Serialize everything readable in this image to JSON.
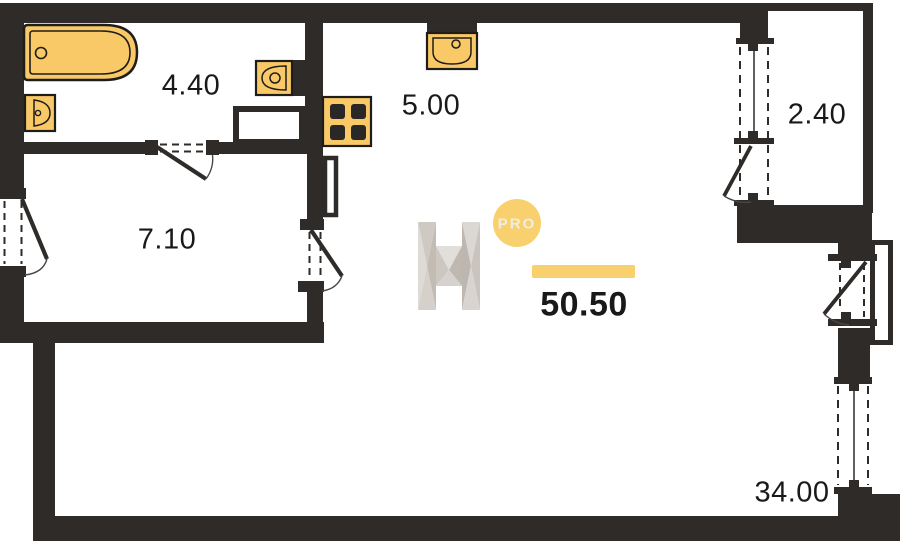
{
  "plan": {
    "title": "apartment floor plan",
    "total_area_label": "50.50",
    "watermark": {
      "logo_letter": "H",
      "badge_label": "PRO"
    },
    "rooms": [
      {
        "name": "bathroom",
        "area_label": "4.40"
      },
      {
        "name": "kitchen",
        "area_label": "5.00"
      },
      {
        "name": "hallway",
        "area_label": "7.10"
      },
      {
        "name": "balcony",
        "area_label": "2.40"
      },
      {
        "name": "living-room",
        "area_label": "34.00"
      }
    ],
    "icons": [
      "bathtub-icon",
      "toilet-icon",
      "washbasin-icon",
      "kitchen-sink-icon",
      "stove-icon"
    ],
    "colors": {
      "wall": "#2e2b29",
      "fixture-fill": "#f9c967",
      "fixture-stroke": "#1f1d1a",
      "accent": "#f8d06e",
      "label-text": "#191919"
    }
  }
}
